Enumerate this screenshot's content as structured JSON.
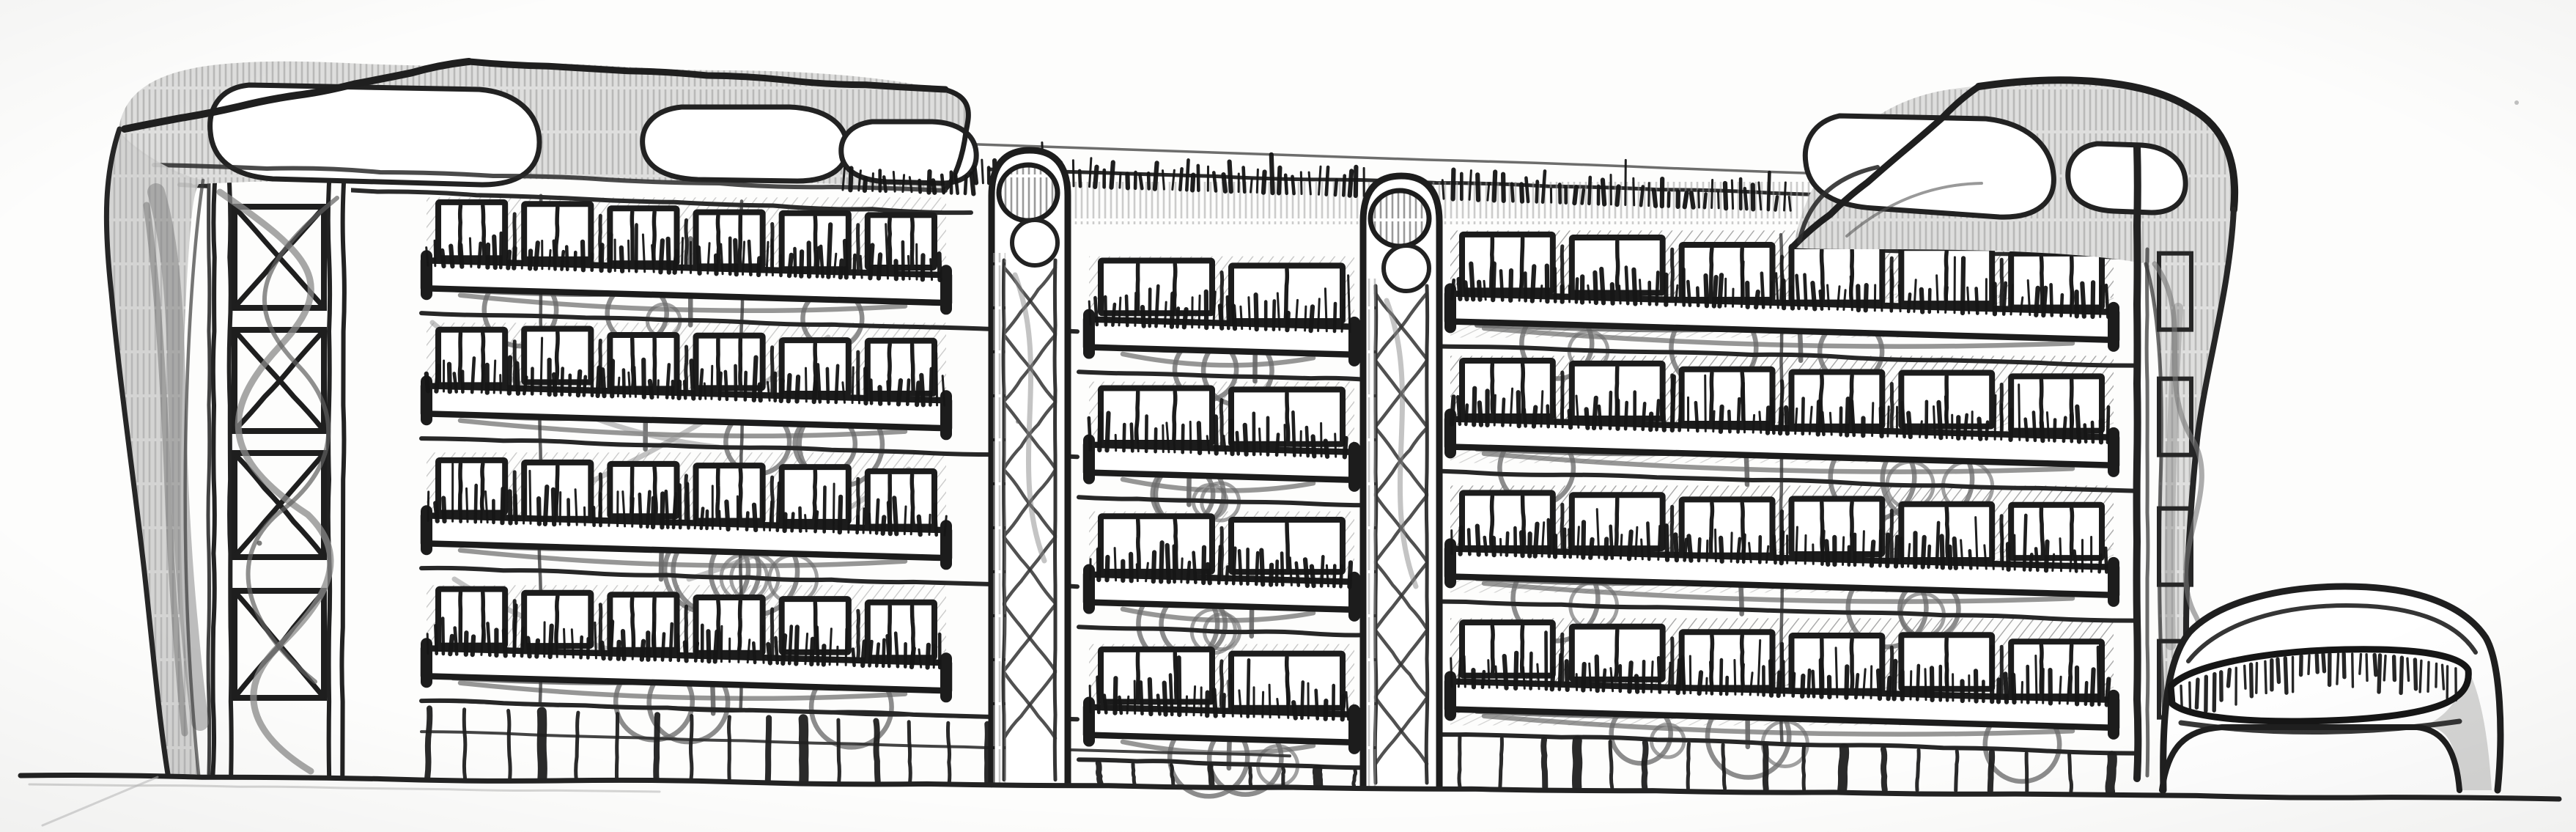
{
  "artwork": {
    "type": "hand-drawn architectural elevation sketch",
    "medium": "pencil on white paper",
    "subject": "Green residential building elevation: four balcony floors with planted parapets over a glazed ground colonnade, corner lattice tower, two cylindrical braced masts, organic melting roof canopies with green roof fringe, and a small arched planter pavilion at the right",
    "floors_above_ground": 4,
    "bays": [
      {
        "name": "left-block",
        "windows_per_floor": 6
      },
      {
        "name": "middle-bay",
        "windows_per_floor": 2
      },
      {
        "name": "right-block",
        "windows_per_floor": 6
      }
    ],
    "towers": {
      "corner_lattice_towers": 1,
      "cylindrical_masts": 2,
      "right_edge_lattice_strip": 1
    },
    "green_roof": true,
    "balcony_planters": true,
    "pavilion": {
      "present": true,
      "style": "rounded arch gate with planted band"
    },
    "palette": {
      "paper": "#fdfdfc",
      "ink": "#1c1c1c",
      "line": "#2a2a2a",
      "vine": "#6f6f6f",
      "pencil_mid": "#8c8c8c",
      "pencil_light": "#a9a9a9",
      "shade_fill": "#dededd",
      "drip_fill": "#cfcfce",
      "streak": "#7e7e7e"
    }
  }
}
